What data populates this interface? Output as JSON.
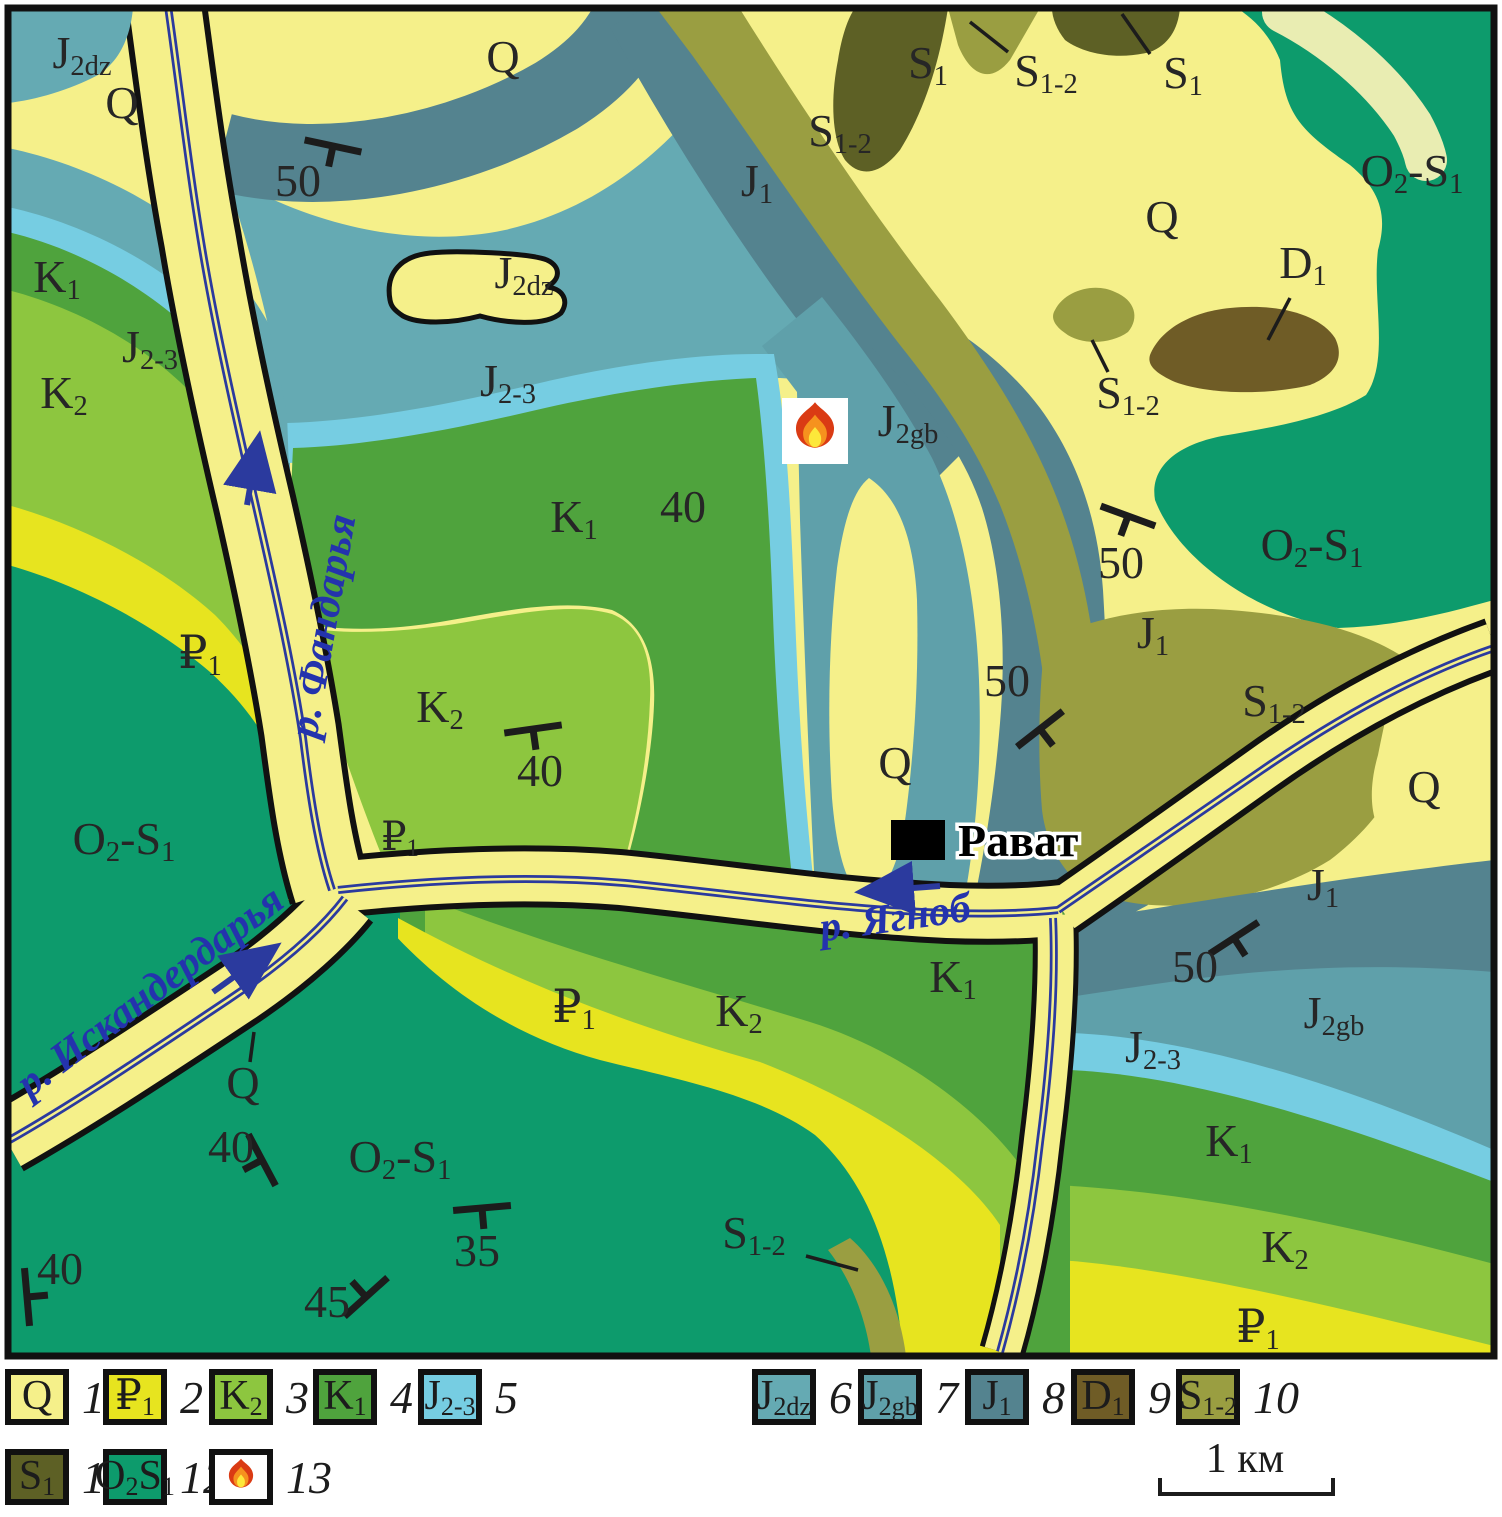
{
  "map": {
    "colors": {
      "Q": "#f5f08a",
      "P1": "#e7e41f",
      "K2": "#8dc63f",
      "K1": "#4fa33d",
      "J23": "#76cde2",
      "J2dz": "#65aab3",
      "J2gb": "#5fa0aa",
      "J1": "#54838f",
      "D1": "#6f5c26",
      "S12": "#9a9e41",
      "S1": "#5d6025",
      "O2S1": "#0d9b6c",
      "paleband": "#e9edb2",
      "river": "#2b3a9e",
      "water_label": "#2433ad",
      "ink": "#1c1c1c"
    },
    "unit_labels": [
      {
        "parts": [
          [
            "J",
            ""
          ],
          [
            "2dz",
            "s"
          ]
        ],
        "x": 82,
        "y": 68
      },
      {
        "parts": [
          [
            "Q",
            ""
          ]
        ],
        "x": 122,
        "y": 118
      },
      {
        "parts": [
          [
            "Q",
            ""
          ]
        ],
        "x": 503,
        "y": 72
      },
      {
        "parts": [
          [
            "S",
            ""
          ],
          [
            "1",
            "s"
          ]
        ],
        "x": 928,
        "y": 78
      },
      {
        "parts": [
          [
            "S",
            ""
          ],
          [
            "1-2",
            "s"
          ]
        ],
        "x": 1046,
        "y": 86,
        "leader": [
          1008,
          52,
          970,
          22
        ]
      },
      {
        "parts": [
          [
            "S",
            ""
          ],
          [
            "1",
            "s"
          ]
        ],
        "x": 1183,
        "y": 88,
        "leader": [
          1150,
          54,
          1122,
          14
        ]
      },
      {
        "parts": [
          [
            "S",
            ""
          ],
          [
            "1-2",
            "s"
          ]
        ],
        "x": 840,
        "y": 146
      },
      {
        "parts": [
          [
            "J",
            ""
          ],
          [
            "1",
            "s"
          ]
        ],
        "x": 757,
        "y": 196
      },
      {
        "parts": [
          [
            "O",
            ""
          ],
          [
            "2",
            "s"
          ],
          [
            "-S",
            ""
          ],
          [
            "1",
            "s"
          ]
        ],
        "x": 1412,
        "y": 186
      },
      {
        "parts": [
          [
            "Q",
            ""
          ]
        ],
        "x": 1162,
        "y": 232
      },
      {
        "parts": [
          [
            "D",
            ""
          ],
          [
            "1",
            "s"
          ]
        ],
        "x": 1303,
        "y": 278,
        "leader": [
          1290,
          298,
          1268,
          340
        ]
      },
      {
        "parts": [
          [
            "J",
            ""
          ],
          [
            "2dz",
            "s"
          ]
        ],
        "x": 524,
        "y": 288
      },
      {
        "parts": [
          [
            "S",
            ""
          ],
          [
            "1-2",
            "s"
          ]
        ],
        "x": 1128,
        "y": 408,
        "leader": [
          1108,
          372,
          1092,
          340
        ]
      },
      {
        "parts": [
          [
            "J",
            ""
          ],
          [
            "2-3",
            "s"
          ]
        ],
        "x": 150,
        "y": 362
      },
      {
        "parts": [
          [
            "K",
            ""
          ],
          [
            "1",
            "s"
          ]
        ],
        "x": 57,
        "y": 292
      },
      {
        "parts": [
          [
            "K",
            ""
          ],
          [
            "2",
            "s"
          ]
        ],
        "x": 64,
        "y": 408
      },
      {
        "parts": [
          [
            "J",
            ""
          ],
          [
            "2-3",
            "s"
          ]
        ],
        "x": 508,
        "y": 396
      },
      {
        "parts": [
          [
            "J",
            ""
          ],
          [
            "2gb",
            "s"
          ]
        ],
        "x": 908,
        "y": 436
      },
      {
        "parts": [
          [
            "K",
            ""
          ],
          [
            "1",
            "s"
          ]
        ],
        "x": 574,
        "y": 532
      },
      {
        "parts": [
          [
            "40",
            ""
          ]
        ],
        "x": 683,
        "y": 522
      },
      {
        "parts": [
          [
            "O",
            ""
          ],
          [
            "2",
            "s"
          ],
          [
            "-S",
            ""
          ],
          [
            "1",
            "s"
          ]
        ],
        "x": 1312,
        "y": 560
      },
      {
        "parts": [
          [
            "J",
            ""
          ],
          [
            "1",
            "s"
          ]
        ],
        "x": 1153,
        "y": 648
      },
      {
        "parts": [
          [
            "S",
            ""
          ],
          [
            "1-2",
            "s"
          ]
        ],
        "x": 1274,
        "y": 716
      },
      {
        "parts": [
          [
            "₽",
            ""
          ],
          [
            "1",
            "s"
          ]
        ],
        "x": 200,
        "y": 668
      },
      {
        "parts": [
          [
            "K",
            ""
          ],
          [
            "2",
            "s"
          ]
        ],
        "x": 440,
        "y": 722
      },
      {
        "parts": [
          [
            "Q",
            ""
          ]
        ],
        "x": 895,
        "y": 778
      },
      {
        "parts": [
          [
            "₽",
            ""
          ],
          [
            "1",
            "s"
          ]
        ],
        "x": 400,
        "y": 850,
        "fs": 40
      },
      {
        "parts": [
          [
            "O",
            ""
          ],
          [
            "2",
            "s"
          ],
          [
            "-S",
            ""
          ],
          [
            "1",
            "s"
          ]
        ],
        "x": 124,
        "y": 854
      },
      {
        "parts": [
          [
            "Q",
            ""
          ]
        ],
        "x": 1424,
        "y": 802
      },
      {
        "parts": [
          [
            "J",
            ""
          ],
          [
            "1",
            "s"
          ]
        ],
        "x": 1323,
        "y": 900
      },
      {
        "parts": [
          [
            "K",
            ""
          ],
          [
            "1",
            "s"
          ]
        ],
        "x": 953,
        "y": 992
      },
      {
        "parts": [
          [
            "J",
            ""
          ],
          [
            "2gb",
            "s"
          ]
        ],
        "x": 1334,
        "y": 1028
      },
      {
        "parts": [
          [
            "₽",
            ""
          ],
          [
            "1",
            "s"
          ]
        ],
        "x": 574,
        "y": 1022
      },
      {
        "parts": [
          [
            "K",
            ""
          ],
          [
            "2",
            "s"
          ]
        ],
        "x": 739,
        "y": 1026
      },
      {
        "parts": [
          [
            "J",
            ""
          ],
          [
            "2-3",
            "s"
          ]
        ],
        "x": 1153,
        "y": 1062
      },
      {
        "parts": [
          [
            "Q",
            ""
          ]
        ],
        "x": 243,
        "y": 1098,
        "leader": [
          250,
          1062,
          254,
          1032
        ]
      },
      {
        "parts": [
          [
            "K",
            ""
          ],
          [
            "1",
            "s"
          ]
        ],
        "x": 1229,
        "y": 1156
      },
      {
        "parts": [
          [
            "O",
            ""
          ],
          [
            "2",
            "s"
          ],
          [
            "-S",
            ""
          ],
          [
            "1",
            "s"
          ]
        ],
        "x": 400,
        "y": 1172
      },
      {
        "parts": [
          [
            "S",
            ""
          ],
          [
            "1-2",
            "s"
          ]
        ],
        "x": 754,
        "y": 1248,
        "leader": [
          806,
          1256,
          858,
          1270
        ]
      },
      {
        "parts": [
          [
            "K",
            ""
          ],
          [
            "2",
            "s"
          ]
        ],
        "x": 1285,
        "y": 1262
      },
      {
        "parts": [
          [
            "₽",
            ""
          ],
          [
            "1",
            "s"
          ]
        ],
        "x": 1258,
        "y": 1342
      }
    ],
    "river_labels": [
      {
        "text": "р. Фандарья",
        "x": 336,
        "y": 628,
        "rot": -80,
        "fs": 42
      },
      {
        "text": "р. Искандердарья",
        "x": 158,
        "y": 1002,
        "rot": -37,
        "fs": 42
      },
      {
        "text": "р. Ягноб",
        "x": 897,
        "y": 931,
        "rot": -8,
        "fs": 42
      }
    ],
    "dips": [
      {
        "x": 333,
        "y": 146,
        "r": 12,
        "num": "50",
        "nx": 298,
        "ny": 196
      },
      {
        "x": 533,
        "y": 729,
        "r": -8,
        "num": "40",
        "nx": 540,
        "ny": 786
      },
      {
        "x": 1128,
        "y": 516,
        "r": 20,
        "num": "50",
        "nx": 1121,
        "ny": 578
      },
      {
        "x": 1040,
        "y": 729,
        "r": -38,
        "num": "50",
        "nx": 1007,
        "ny": 696
      },
      {
        "x": 1234,
        "y": 938,
        "r": -33,
        "num": "50",
        "nx": 1195,
        "ny": 982
      },
      {
        "x": 262,
        "y": 1160,
        "r": 62,
        "num": "40",
        "nx": 231,
        "ny": 1162
      },
      {
        "x": 482,
        "y": 1208,
        "r": -5,
        "num": "35",
        "nx": 477,
        "ny": 1266
      },
      {
        "x": 366,
        "y": 1297,
        "r": -42,
        "flip": true,
        "num": "45",
        "nx": 327,
        "ny": 1317
      },
      {
        "x": 27,
        "y": 1297,
        "r": 85,
        "flip": true,
        "num": "40",
        "nx": 60,
        "ny": 1284
      }
    ],
    "arrows": [
      {
        "x1": 247,
        "y1": 505,
        "x2": 257,
        "y2": 448
      },
      {
        "x1": 213,
        "y1": 992,
        "x2": 267,
        "y2": 953
      },
      {
        "x1": 940,
        "y1": 886,
        "x2": 872,
        "y2": 891
      }
    ],
    "town": {
      "label": "Рават",
      "tx": 958,
      "ty": 856,
      "mx": 891,
      "my": 820,
      "mw": 54,
      "mh": 40
    },
    "fire": {
      "x": 782,
      "y": 398,
      "size": 66
    }
  },
  "legend": {
    "rows": [
      [
        {
          "unit": "Q",
          "parts": [
            [
              "Q",
              ""
            ]
          ],
          "num": "1"
        },
        {
          "unit": "P1",
          "parts": [
            [
              "₽",
              ""
            ],
            [
              "1",
              "s"
            ]
          ],
          "num": "2"
        },
        {
          "unit": "K2",
          "parts": [
            [
              "K",
              ""
            ],
            [
              "2",
              "s"
            ]
          ],
          "num": "3"
        },
        {
          "unit": "K1",
          "parts": [
            [
              "K",
              ""
            ],
            [
              "1",
              "s"
            ]
          ],
          "num": "4"
        },
        {
          "unit": "J23",
          "parts": [
            [
              "J",
              ""
            ],
            [
              "2-3",
              "s"
            ]
          ],
          "num": "5"
        },
        {
          "unit": "J2dz",
          "parts": [
            [
              "J",
              ""
            ],
            [
              "2dz",
              "s"
            ]
          ],
          "num": "6"
        },
        {
          "unit": "J2gb",
          "parts": [
            [
              "J",
              ""
            ],
            [
              "2gb",
              "s"
            ]
          ],
          "num": "7"
        },
        {
          "unit": "J1",
          "parts": [
            [
              "J",
              ""
            ],
            [
              "1",
              "s"
            ]
          ],
          "num": "8"
        },
        {
          "unit": "D1",
          "parts": [
            [
              "D",
              ""
            ],
            [
              "1",
              "s"
            ]
          ],
          "num": "9"
        },
        {
          "unit": "S12",
          "parts": [
            [
              "S",
              ""
            ],
            [
              "1-2",
              "s"
            ]
          ],
          "num": "10"
        }
      ],
      [
        {
          "unit": "S1",
          "parts": [
            [
              "S",
              ""
            ],
            [
              "1",
              "s"
            ]
          ],
          "num": "11"
        },
        {
          "unit": "O2S1",
          "parts": [
            [
              "O",
              ""
            ],
            [
              "2",
              "s"
            ],
            [
              "S",
              ""
            ],
            [
              "1",
              "s"
            ]
          ],
          "num": "12"
        },
        {
          "unit": "fire",
          "parts": [],
          "num": "13"
        }
      ]
    ],
    "scale_label": "1 км"
  }
}
